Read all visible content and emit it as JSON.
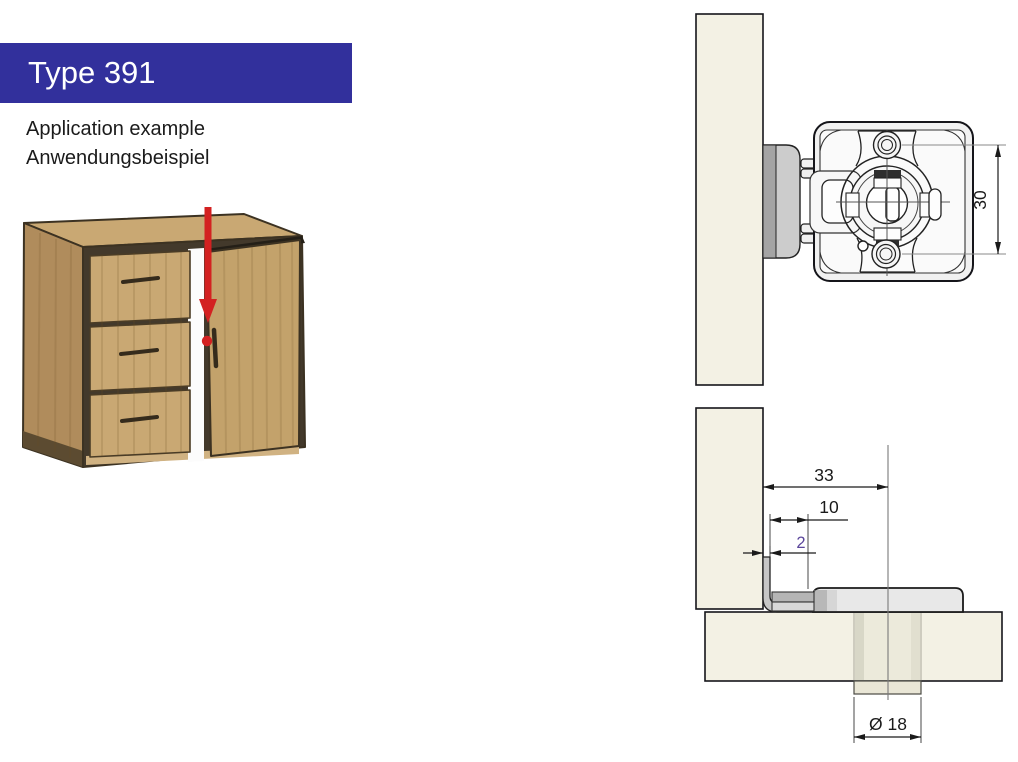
{
  "header": {
    "title": "Type 391"
  },
  "subtitle": {
    "line1": "Application example",
    "line2": "Anwendungsbeispiel"
  },
  "front_view": {
    "dim_screw_spacing": "30"
  },
  "section_view": {
    "dim_total_depth": "33",
    "dim_latch_projection": "10",
    "dim_door_gap": "2",
    "dim_hole_diameter": "Ø 18"
  },
  "colors": {
    "banner_blue": "#32309c",
    "accent_red": "#d32121",
    "highlight_purple": "#5b469b",
    "wood_tan": "#c9a873",
    "panel_cream": "#f3f1e4"
  }
}
